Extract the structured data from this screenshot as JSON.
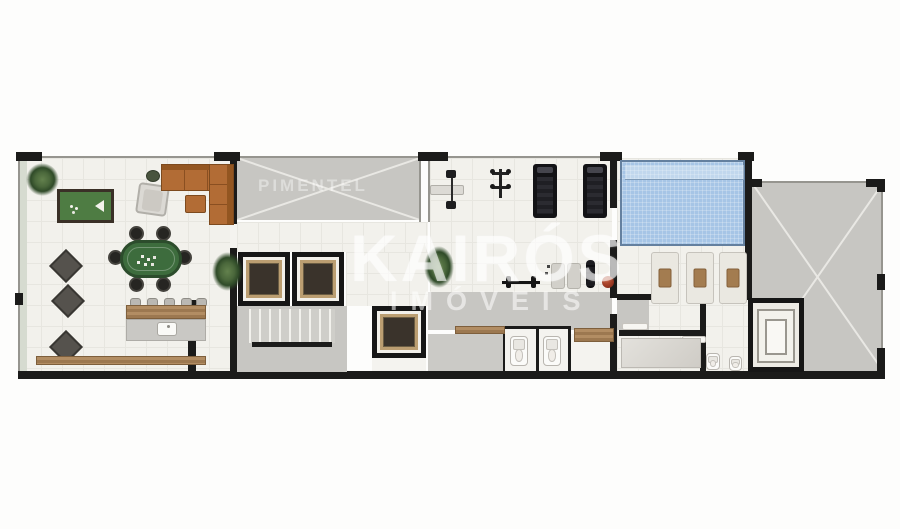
{
  "meta": {
    "type": "architectural-floorplan",
    "view": "top-down-leisure-floor-render",
    "canvas": {
      "width": 900,
      "height": 529
    }
  },
  "watermarks": {
    "brand_main": "KAIRÓS",
    "brand_sub": "IMÓVEIS",
    "brand_secondary": "PIMENTEL"
  },
  "palette": {
    "wall_black": "#1b1b1a",
    "wall_thin_gray": "#96958f",
    "floor_cream": "#f2f1ec",
    "ramp_gray": "#c7c6c2",
    "pool_blue": "#a6c5e6",
    "billiard_green": "#4e7c43",
    "poker_green": "#3d6c3d",
    "sofa_brown": "#b26c35",
    "wood": "#a8885f",
    "elevator_trim": "#bb9e71",
    "plant_green": "#4a673b",
    "medicine_ball_red": "#9c3a24",
    "planter_strip": "#d6dbd0"
  },
  "rooms": [
    {
      "id": "games-lounge",
      "furniture": [
        "plant",
        "billiard-table",
        "armchair",
        "pouf",
        "l-shaped-sofa",
        "ottoman",
        "poker-table",
        "poker-chairs",
        "bistro-table",
        "bistro-table",
        "bistro-table",
        "bar-stools",
        "bar-counter-wood",
        "bar-counter-base",
        "sink",
        "long-bench",
        "plant"
      ]
    },
    {
      "id": "circulation-core",
      "furniture": [
        "void-cross-area",
        "elevator",
        "elevator",
        "staircase",
        "service-elevator"
      ]
    },
    {
      "id": "gym",
      "furniture": [
        "bench-press",
        "weight-rack",
        "treadmill",
        "treadmill",
        "plant",
        "barbell",
        "exercise-mat",
        "exercise-mat",
        "foam-roller",
        "medicine-ball"
      ]
    },
    {
      "id": "changing-rooms",
      "furniture": [
        "wood-bench",
        "toilet",
        "toilet",
        "wood-bench"
      ]
    },
    {
      "id": "pool-deck",
      "furniture": [
        "swimming-pool",
        "sun-lounger",
        "sun-lounger",
        "sun-lounger"
      ]
    },
    {
      "id": "service-rooms",
      "furniture": [
        "shelf",
        "shelf",
        "vanity-counter",
        "toilet",
        "toilet",
        "spiral-stair"
      ]
    },
    {
      "id": "ramp-area",
      "furniture": [
        "void-cross-area"
      ]
    }
  ]
}
